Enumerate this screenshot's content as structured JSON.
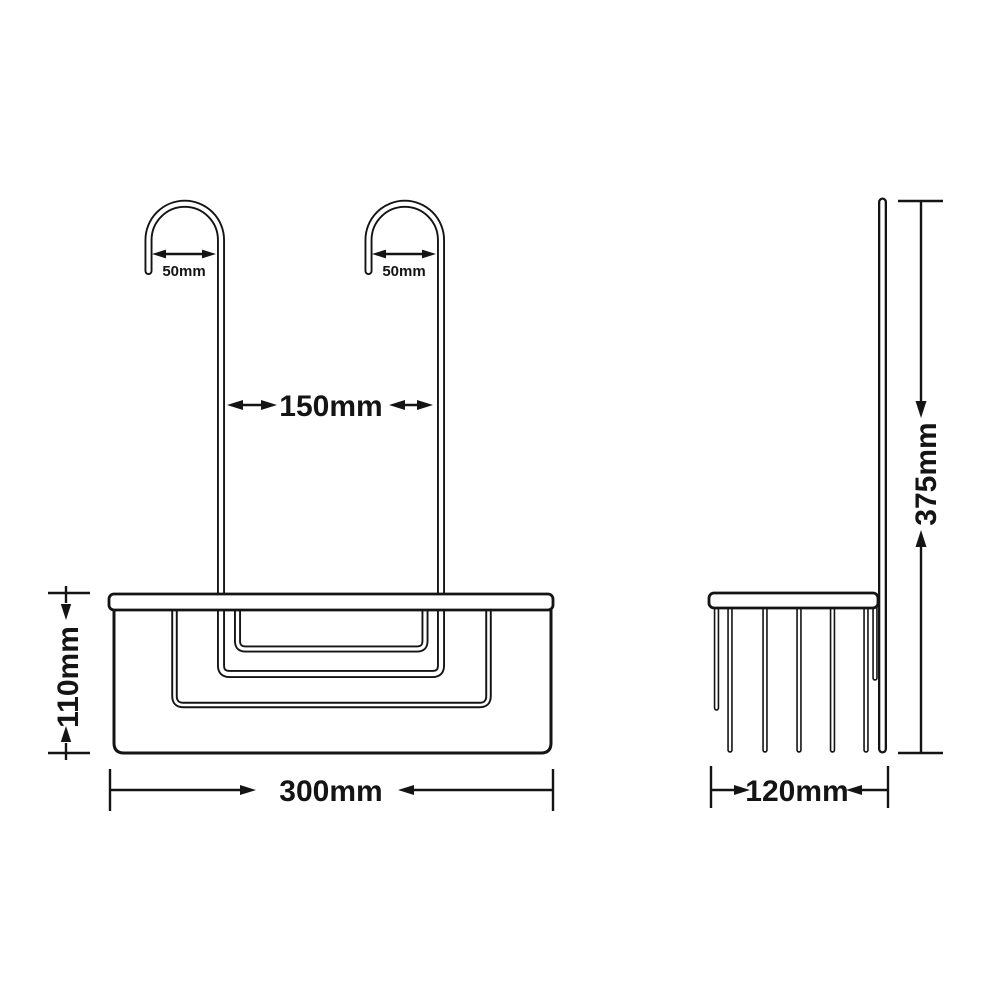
{
  "drawing": {
    "kind": "technical-dimension-drawing",
    "background_color": "#ffffff",
    "line_color": "#141414",
    "views": [
      "front",
      "side"
    ]
  },
  "dimensions": {
    "left_hook_width": "50mm",
    "right_hook_width": "50mm",
    "hook_spacing": "150mm",
    "basket_height": "110mm",
    "basket_width": "300mm",
    "overall_height": "375mm",
    "basket_depth": "120mm"
  }
}
